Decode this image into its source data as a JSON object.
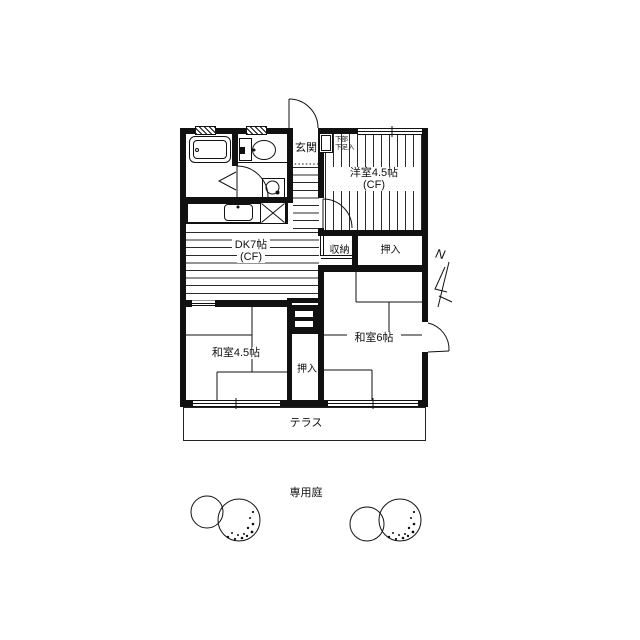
{
  "floorplan": {
    "western_room": {
      "label": "洋室4.5帖",
      "floor_note": "(CF)"
    },
    "dining_kitchen": {
      "label": "DK7帖",
      "floor_note": "(CF)"
    },
    "tatami_room_45": {
      "label": "和室4.5帖"
    },
    "tatami_room_6": {
      "label": "和室6帖"
    },
    "entrance": {
      "label": "玄関"
    },
    "shoe_cabinet": {
      "line1": "下部",
      "line2": "下足入"
    },
    "storage": {
      "label": "収納"
    },
    "closet_upper": {
      "label": "押入"
    },
    "closet_lower": {
      "label": "押入"
    },
    "terrace": {
      "label": "テラス"
    },
    "garden": {
      "label": "専用庭"
    },
    "compass": {
      "label": "N"
    }
  },
  "colors": {
    "line": "#111111",
    "background": "#ffffff"
  }
}
